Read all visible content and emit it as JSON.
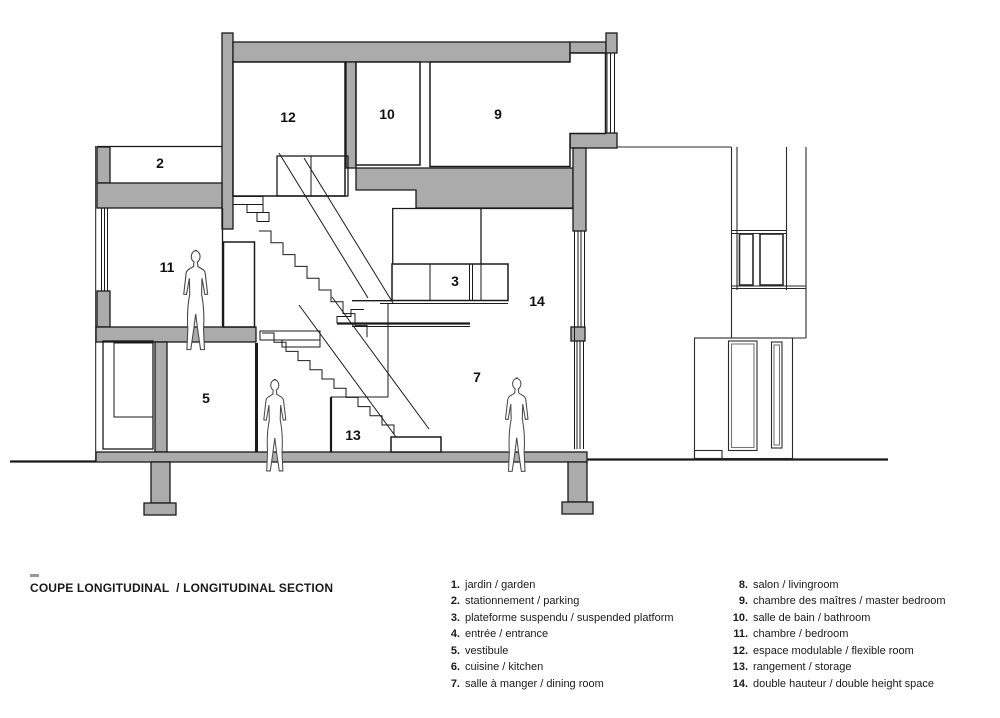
{
  "colors": {
    "poche": "#ababab",
    "line": "#1a1a1a",
    "background": "#ffffff"
  },
  "drawing": {
    "room_labels": [
      "2",
      "12",
      "10",
      "9",
      "11",
      "3",
      "14",
      "5",
      "13",
      "7"
    ]
  },
  "title_block": {
    "title": "COUPE LONGITUDINAL  / LONGITUDINAL SECTION"
  },
  "legend": {
    "col1": [
      {
        "num": "1.",
        "label": "jardin / garden"
      },
      {
        "num": "2.",
        "label": "stationnement / parking"
      },
      {
        "num": "3.",
        "label": "plateforme suspendu / suspended platform"
      },
      {
        "num": "4.",
        "label": "entrée / entrance"
      },
      {
        "num": "5.",
        "label": "vestibule"
      },
      {
        "num": "6.",
        "label": "cuisine / kitchen"
      },
      {
        "num": "7.",
        "label": "salle à manger / dining room"
      }
    ],
    "col2": [
      {
        "num": "8.",
        "label": "salon / livingroom"
      },
      {
        "num": "9.",
        "label": "chambre des maîtres / master bedroom"
      },
      {
        "num": "10.",
        "label": "salle de bain / bathroom"
      },
      {
        "num": "11.",
        "label": "chambre / bedroom"
      },
      {
        "num": "12.",
        "label": "espace modulable / flexible room"
      },
      {
        "num": "13.",
        "label": "rangement / storage"
      },
      {
        "num": "14.",
        "label": "double hauteur / double height space"
      }
    ]
  }
}
